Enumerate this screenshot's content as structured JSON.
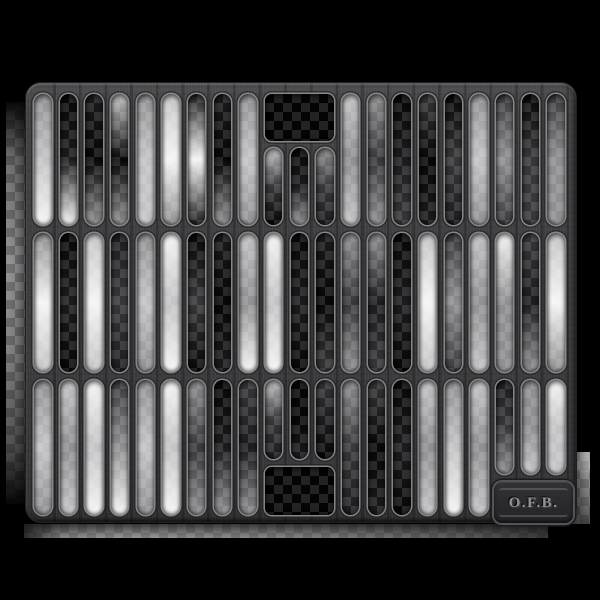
{
  "badge": {
    "text": "O.F.B."
  },
  "background": {
    "color": "#000000"
  },
  "colors": {
    "plate": "#3e3e40",
    "plate_highlight": "#5a5a5c",
    "plate_shadow": "#2a2a2c",
    "slot_rim": "#e2e2e4",
    "checker_light": "#c9c9cb",
    "checker_mid": "#8e8e90",
    "badge_panel": "#2a2a2c",
    "badge_rim": "#545456",
    "badge_text": "#929294",
    "opening_interior": "#040404"
  },
  "grate": {
    "x": 25,
    "y": 82,
    "width": 552,
    "height": 441,
    "corner_radius": 16,
    "columns": 21,
    "col_start": 33,
    "col_pitch": 25.66,
    "slot_width": 17.5,
    "slot_radius": 9,
    "rows": [
      {
        "name": "top",
        "y": 93,
        "h": 131
      },
      {
        "name": "middle",
        "y": 232,
        "h": 139
      },
      {
        "name": "bottom",
        "y": 379,
        "h": 135
      }
    ],
    "features": {
      "top_opening": {
        "x": 263.5,
        "y": 93,
        "w": 69.5,
        "h": 47,
        "r": 7,
        "fill": [
          "#040404",
          "#040404",
          "#040404"
        ]
      },
      "top_short_slots": {
        "cols": [
          9,
          10,
          11
        ],
        "y": 147,
        "h": 77
      },
      "bottom_opening": {
        "x": 263.5,
        "y": 466,
        "w": 69.5,
        "h": 48,
        "r": 7,
        "fill": [
          "#040404",
          "#040404",
          "#040404"
        ]
      },
      "bottom_short_slots": {
        "cols": [
          9,
          10,
          11
        ],
        "y": 379,
        "h": 79
      },
      "badge_short_slots": {
        "cols": [
          18,
          19,
          20
        ],
        "y": 379,
        "h": 94
      }
    },
    "fills": {
      "top": [
        [
          "#909092",
          "#c4c4c6",
          "#f5f5f5"
        ],
        [
          "#070707",
          "#1c1c1e",
          "#f5f5f5"
        ],
        [
          "#1c1c1e",
          "#070707",
          "#909092"
        ],
        [
          "#c4c4c6",
          "#070707",
          "#909092"
        ],
        [
          "#909092",
          "#c4c4c6",
          "#c4c4c6"
        ],
        [
          "#c4c4c6",
          "#f5f5f5",
          "#909092"
        ],
        [
          "#1c1c1e",
          "#f5f5f5",
          "#1c1c1e"
        ],
        [
          "#1c1c1e",
          "#070707",
          "#909092"
        ],
        [
          "#909092",
          "#c4c4c6",
          "#909092"
        ],
        [
          "#c4c4c6",
          "#38383a",
          "#070707"
        ],
        [
          "#070707",
          "#1c1c1e",
          "#909092"
        ],
        [
          "#909092",
          "#38383a",
          "#1c1c1e"
        ],
        [
          "#c4c4c6",
          "#909092",
          "#c4c4c6"
        ],
        [
          "#909092",
          "#38383a",
          "#909092"
        ],
        [
          "#070707",
          "#1c1c1e",
          "#38383a"
        ],
        [
          "#38383a",
          "#070707",
          "#1c1c1e"
        ],
        [
          "#070707",
          "#38383a",
          "#1c1c1e"
        ],
        [
          "#909092",
          "#c4c4c6",
          "#909092"
        ],
        [
          "#38383a",
          "#909092",
          "#38383a"
        ],
        [
          "#070707",
          "#38383a",
          "#38383a"
        ],
        [
          "#38383a",
          "#909092",
          "#909092"
        ]
      ],
      "middle": [
        [
          "#909092",
          "#f5f5f5",
          "#c4c4c6"
        ],
        [
          "#070707",
          "#1c1c1e",
          "#070707"
        ],
        [
          "#c4c4c6",
          "#f5f5f5",
          "#c4c4c6"
        ],
        [
          "#1c1c1e",
          "#38383a",
          "#1c1c1e"
        ],
        [
          "#909092",
          "#c4c4c6",
          "#909092"
        ],
        [
          "#f5f5f5",
          "#c4c4c6",
          "#f5f5f5"
        ],
        [
          "#070707",
          "#38383a",
          "#070707"
        ],
        [
          "#1c1c1e",
          "#070707",
          "#1c1c1e"
        ],
        [
          "#c4c4c6",
          "#909092",
          "#f5f5f5"
        ],
        [
          "#f5f5f5",
          "#c4c4c6",
          "#f5f5f5"
        ],
        [
          "#070707",
          "#1c1c1e",
          "#070707"
        ],
        [
          "#1c1c1e",
          "#070707",
          "#38383a"
        ],
        [
          "#909092",
          "#38383a",
          "#909092"
        ],
        [
          "#909092",
          "#1c1c1e",
          "#38383a"
        ],
        [
          "#070707",
          "#1c1c1e",
          "#070707"
        ],
        [
          "#c4c4c6",
          "#f5f5f5",
          "#c4c4c6"
        ],
        [
          "#38383a",
          "#909092",
          "#38383a"
        ],
        [
          "#c4c4c6",
          "#909092",
          "#c4c4c6"
        ],
        [
          "#f5f5f5",
          "#909092",
          "#909092"
        ],
        [
          "#38383a",
          "#1c1c1e",
          "#909092"
        ],
        [
          "#c4c4c6",
          "#f5f5f5",
          "#909092"
        ]
      ],
      "bottom": [
        [
          "#909092",
          "#c4c4c6",
          "#909092"
        ],
        [
          "#c4c4c6",
          "#909092",
          "#c4c4c6"
        ],
        [
          "#f5f5f5",
          "#c4c4c6",
          "#f5f5f5"
        ],
        [
          "#38383a",
          "#909092",
          "#f5f5f5"
        ],
        [
          "#909092",
          "#c4c4c6",
          "#909092"
        ],
        [
          "#f5f5f5",
          "#c4c4c6",
          "#f5f5f5"
        ],
        [
          "#909092",
          "#38383a",
          "#909092"
        ],
        [
          "#070707",
          "#1c1c1e",
          "#909092"
        ],
        [
          "#38383a",
          "#1c1c1e",
          "#909092"
        ],
        [
          "#c4c4c6",
          "#38383a",
          "#1c1c1e"
        ],
        [
          "#070707",
          "#070707",
          "#1c1c1e"
        ],
        [
          "#38383a",
          "#1c1c1e",
          "#070707"
        ],
        [
          "#909092",
          "#38383a",
          "#1c1c1e"
        ],
        [
          "#38383a",
          "#070707",
          "#1c1c1e"
        ],
        [
          "#070707",
          "#1c1c1e",
          "#070707"
        ],
        [
          "#c4c4c6",
          "#909092",
          "#c4c4c6"
        ],
        [
          "#909092",
          "#c4c4c6",
          "#f5f5f5"
        ],
        [
          "#c4c4c6",
          "#909092",
          "#c4c4c6"
        ],
        [
          "#1c1c1e",
          "#38383a",
          "#909092"
        ],
        [
          "#909092",
          "#909092",
          "#c4c4c6"
        ],
        [
          "#f5f5f5",
          "#c4c4c6",
          "#c4c4c6"
        ]
      ]
    }
  }
}
